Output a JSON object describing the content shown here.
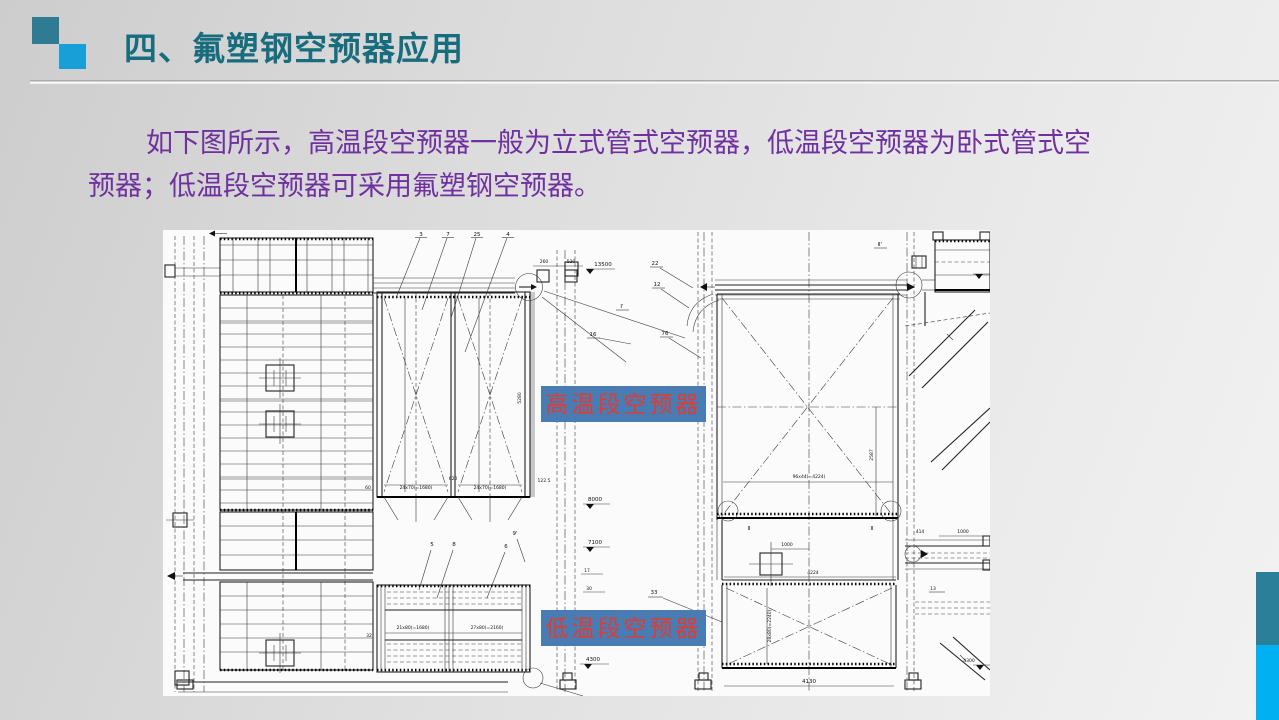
{
  "slide": {
    "title": "四、氟塑钢空预器应用",
    "body_lines": [
      "如下图所示，高温段空预器一般为立式管式空预器，低温段空预器为卧式管式空",
      "预器；低温段空预器可采用氟塑钢空预器。"
    ]
  },
  "callouts": {
    "high_temp": "高温段空预器",
    "low_temp": "低温段空预器"
  },
  "colors": {
    "title_text": "#176d7e",
    "body_text": "#7030a0",
    "callout_bg": "#4a7cb4",
    "callout_text": "#e13a2f",
    "square_dark": "#2e7b93",
    "square_light": "#199fd8",
    "edge_bar_teal": "#2c7f99",
    "edge_bar_blue": "#00b0f0",
    "drawing_bg": "#fbfbfb"
  },
  "drawing": {
    "part_numbers": {
      "n3": "3",
      "n7": "7",
      "n25": "25",
      "n4": "4",
      "n22": "22",
      "n12": "12",
      "n76": "76",
      "n16": "16",
      "n5": "5",
      "n8": "8",
      "n6": "6",
      "n9": "9'",
      "n33": "33",
      "n32": "32",
      "n13": "13"
    },
    "sections": {
      "s2a": "Ⅱ",
      "s2b": "Ⅱ",
      "s2c": "Ⅱ'",
      "s1": "Ⅰ'"
    },
    "elevations": {
      "e13500": "13500",
      "e8000": "8000",
      "e7100": "7100",
      "e17": "17",
      "e30": "30",
      "e4300a": "4300",
      "e4300b": "4300"
    },
    "dimensions": {
      "d60": "60",
      "d620": "620",
      "d24x70a": "24x70(=1680)",
      "d24x70b": "24x70(=1680)",
      "d122": "122.5",
      "d5280": "5280",
      "d260": "260",
      "d520": "520",
      "d21x80": "21x80(=1680)",
      "d27x80": "27x80(=2160)",
      "d96x44": "96x44(=4224)",
      "d1000a": "1000",
      "d4224": "4224",
      "d2587": "2587",
      "d28x80": "28x80(=2240)",
      "d4130": "4130",
      "d414": "414",
      "d1000b": "1000"
    }
  }
}
